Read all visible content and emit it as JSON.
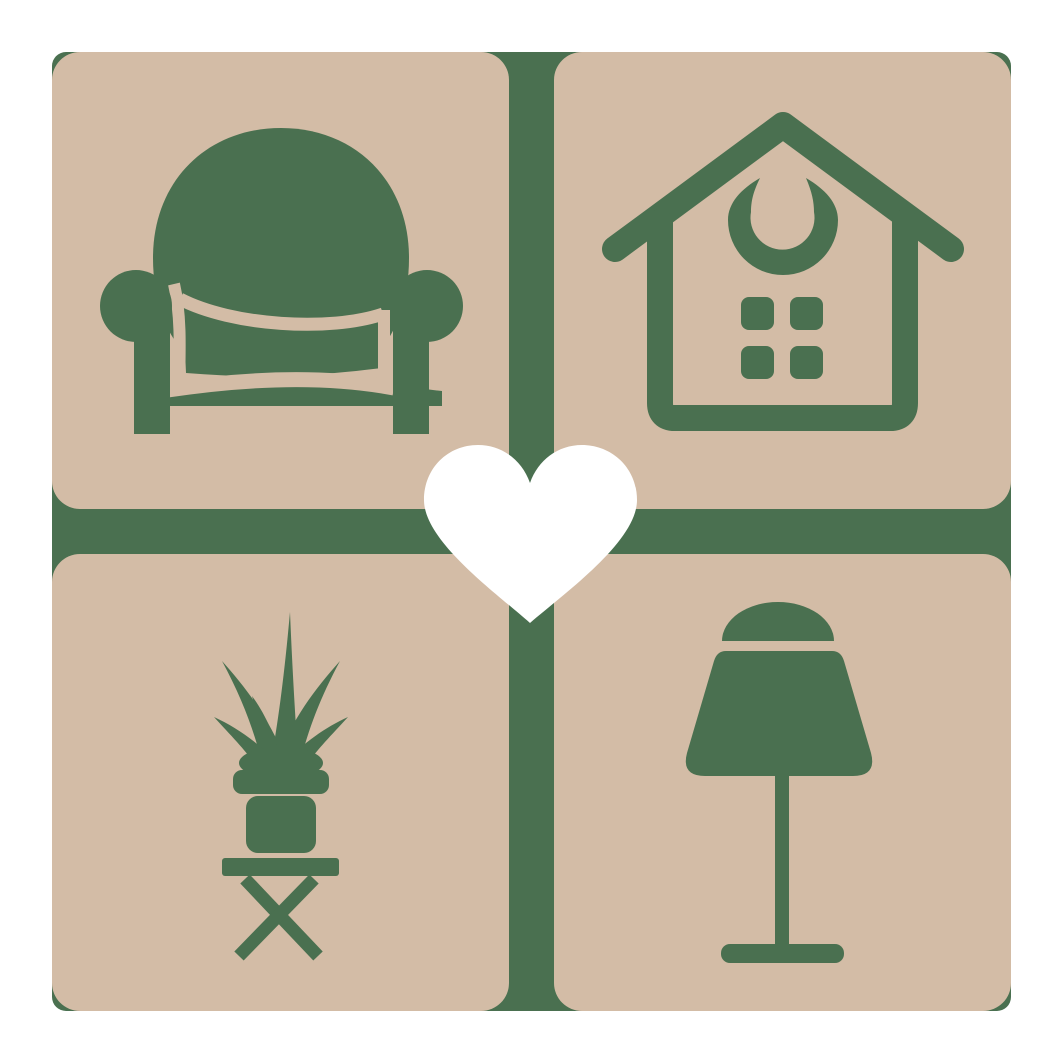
{
  "logo": {
    "name": "home-decor-heart-logo",
    "description": "Four tan rounded tiles on a green grid showing home furnishing icons with a white heart at the center",
    "colors": {
      "page_background": "#ffffff",
      "grid_green": "#4a7050",
      "tile_tan": "#d3bca6",
      "icon_green": "#4a7050",
      "heart_white": "#ffffff"
    },
    "tiles": [
      {
        "position": "top-left",
        "icon": "armchair-icon"
      },
      {
        "position": "top-right",
        "icon": "house-icon"
      },
      {
        "position": "bottom-left",
        "icon": "potted-plant-icon"
      },
      {
        "position": "bottom-right",
        "icon": "lamp-icon"
      }
    ],
    "center": {
      "icon": "heart-icon"
    }
  }
}
